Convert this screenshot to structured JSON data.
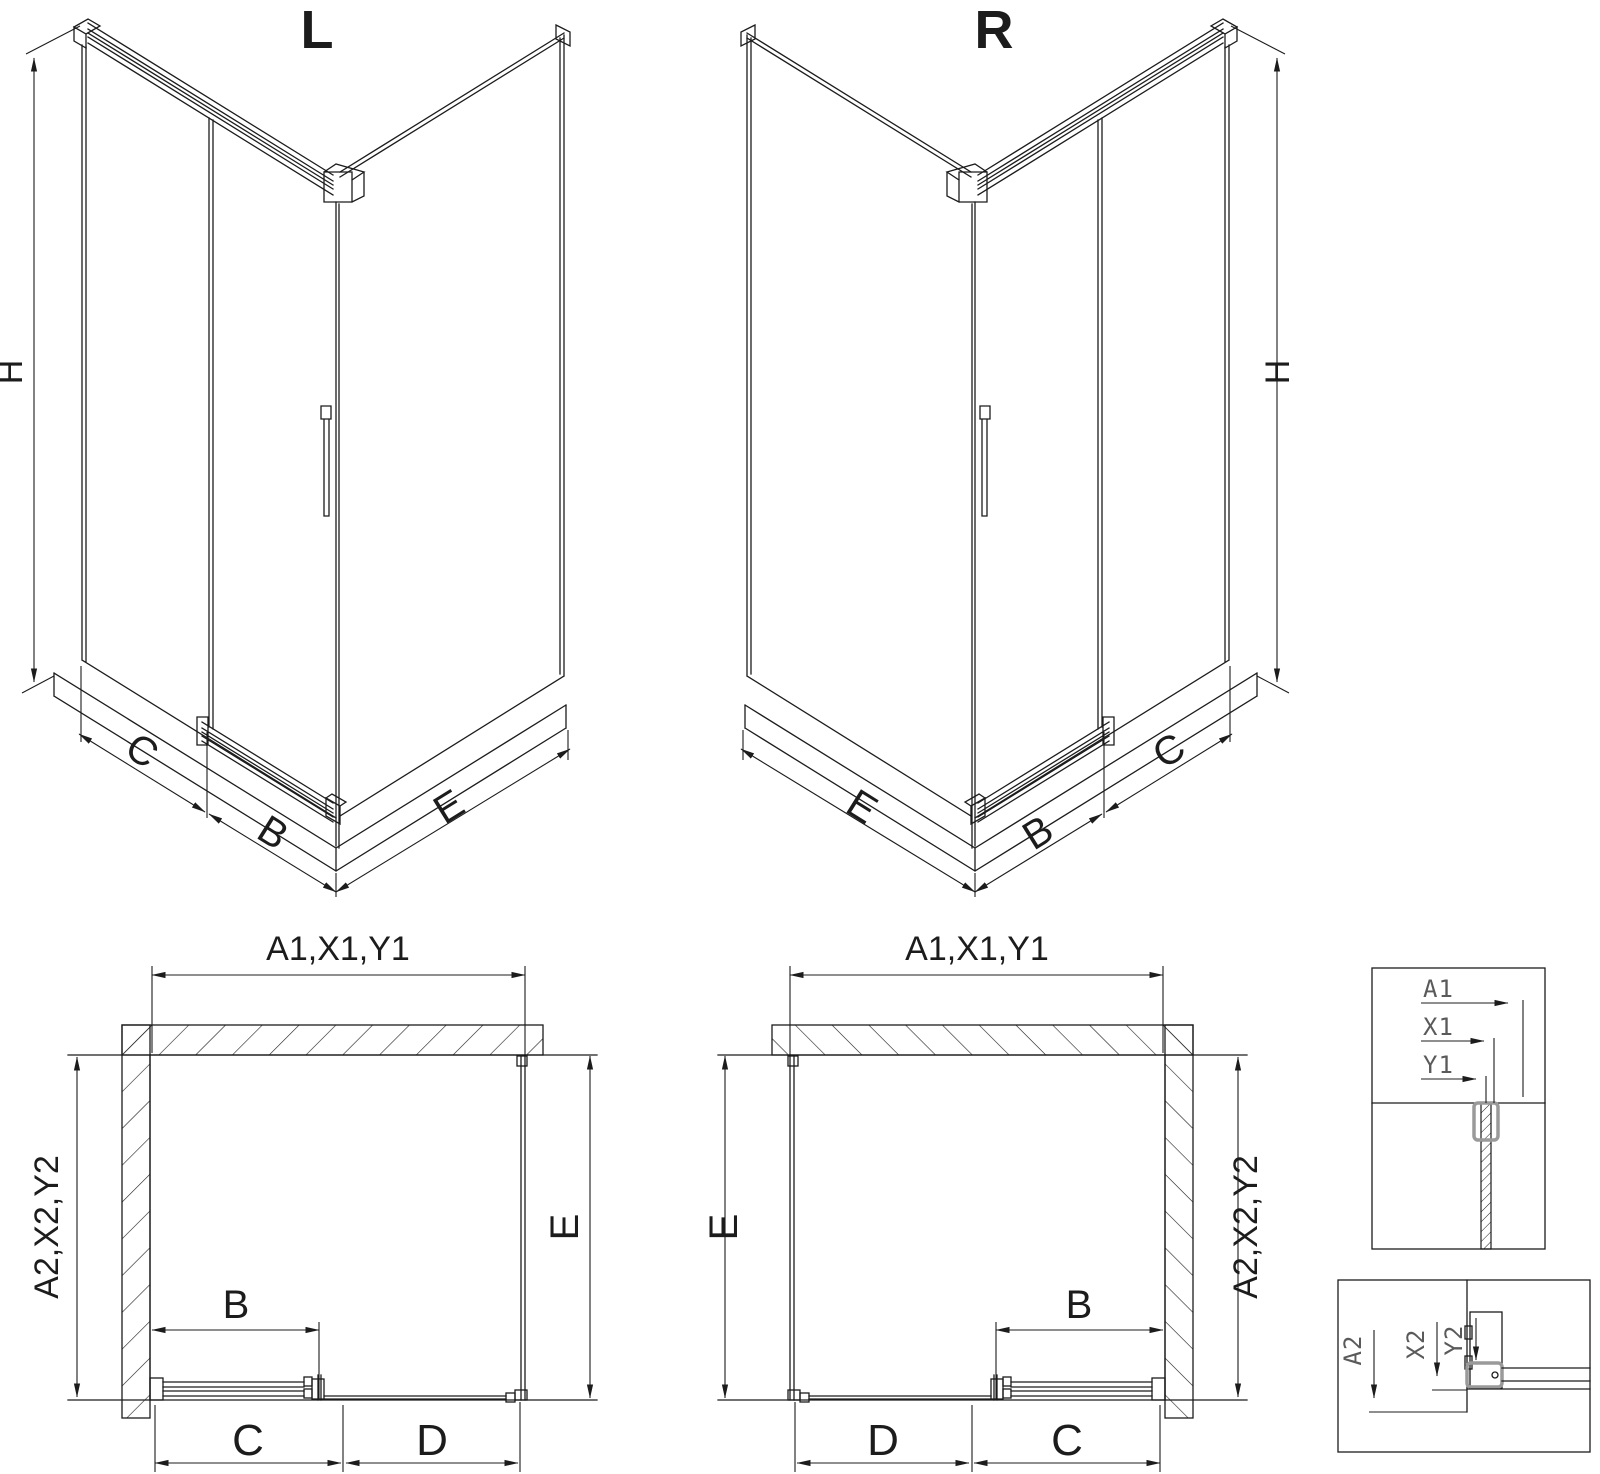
{
  "drawing": {
    "iso_left": {
      "title": "L",
      "dim_height": "H",
      "dim_back_panel": "C",
      "dim_door": "B",
      "dim_side_panel": "E"
    },
    "iso_right": {
      "title": "R",
      "dim_height": "H",
      "dim_back_panel": "C",
      "dim_door": "B",
      "dim_side_panel": "E"
    },
    "plan_left": {
      "dim_top": "A1,X1,Y1",
      "dim_left": "A2,X2,Y2",
      "dim_right": "E",
      "dim_door": "B",
      "dim_bottom_left": "C",
      "dim_bottom_right": "D"
    },
    "plan_right": {
      "dim_top": "A1,X1,Y1",
      "dim_left": "E",
      "dim_right": "A2,X2,Y2",
      "dim_door": "B",
      "dim_bottom_left": "D",
      "dim_bottom_right": "C"
    },
    "detail_top": {
      "labels": [
        "A1",
        "X1",
        "Y1"
      ]
    },
    "detail_bottom": {
      "labels": [
        "A2",
        "X2",
        "Y2"
      ]
    },
    "colors": {
      "line": "#1c1c1c",
      "accent_gray": "#9a9a9a",
      "background": "#ffffff"
    }
  }
}
